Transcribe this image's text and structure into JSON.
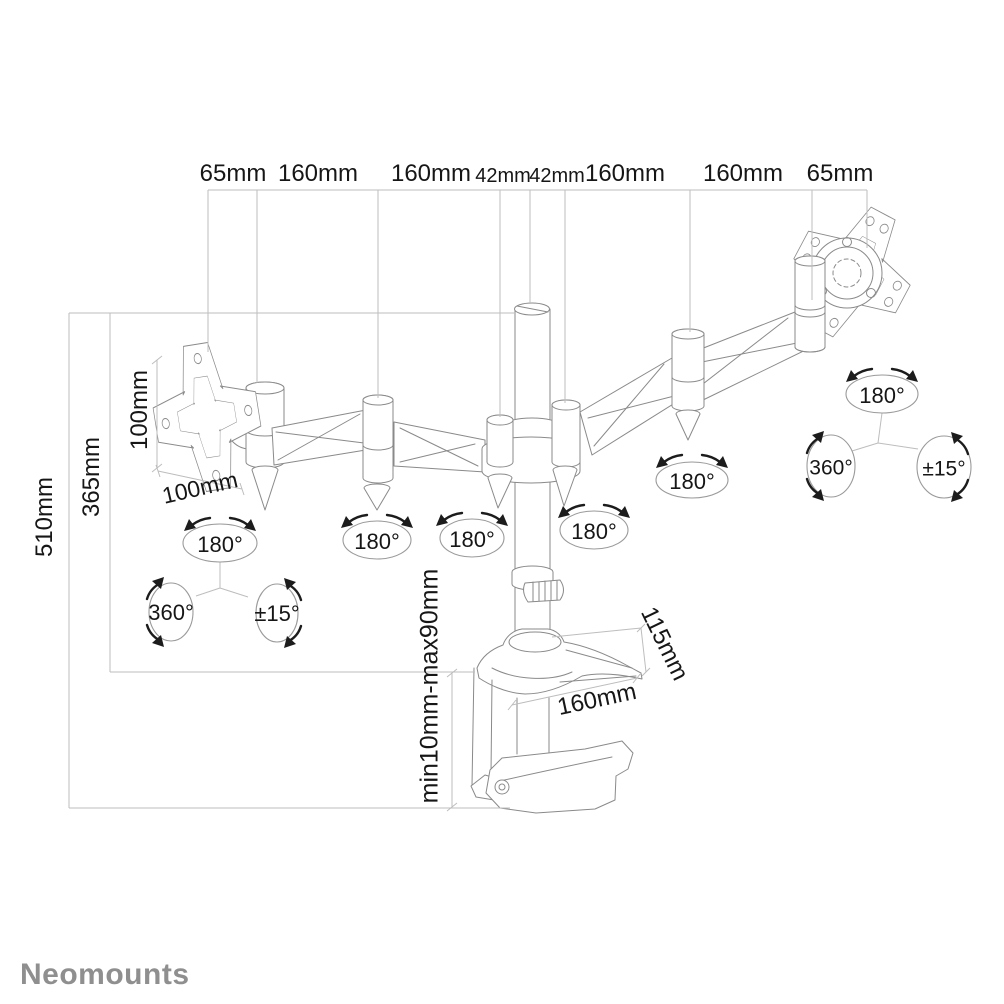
{
  "brand": {
    "logo_text": "Neomounts",
    "logo_color": "#8f8f8f"
  },
  "colors": {
    "background": "#ffffff",
    "drawing_line": "#8a8a8a",
    "dimension_line": "#bdbdbd",
    "label_text": "#161616",
    "arrow": "#1c1c1c"
  },
  "dimensions": {
    "top_row": [
      "65mm",
      "160mm",
      "160mm",
      "42mm",
      "42mm",
      "160mm",
      "160mm",
      "65mm"
    ],
    "height_total": "510mm",
    "height_arm": "365mm",
    "vesa_height": "100mm",
    "vesa_width": "100mm",
    "clamp_depth": "115mm",
    "clamp_width": "160mm",
    "desk_thickness": "min10mm-max90mm"
  },
  "rotation_labels": {
    "arm_joints": [
      "180°",
      "180°",
      "180°",
      "180°"
    ],
    "left_vesa_group": {
      "swivel": "180°",
      "rotation": "360°",
      "tilt": "±15°"
    },
    "right_vesa_group": {
      "swivel": "180°",
      "rotation": "360°",
      "tilt": "±15°"
    }
  }
}
